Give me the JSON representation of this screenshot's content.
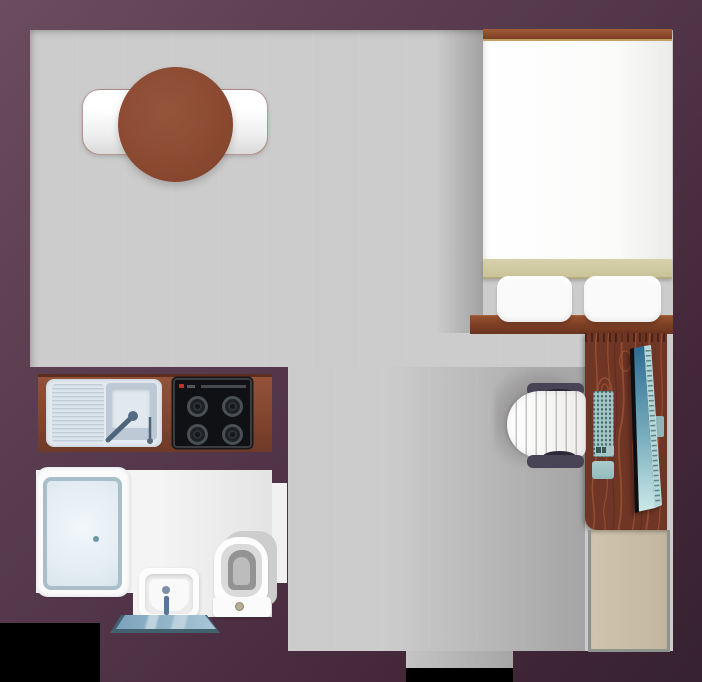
{
  "scene": {
    "title": "Studio apartment floor plan",
    "type": "floor-plan",
    "view": "top-down"
  },
  "palette": {
    "background": "#000000",
    "wall_light": "#6b4d5f",
    "wall_mid": "#53364a",
    "wall_dark": "#362230",
    "floor_gray": "#cccccc",
    "bath_floor": "#f4f4f4",
    "counter_wood": "#83462f",
    "desk_wood": "#6f3525",
    "desk_grain": "#9b5134",
    "table_wood": "#8b4a31",
    "bed_frame": "#7c3d24",
    "blanket_khaki": "#cac39a",
    "linen_white": "#fafafa",
    "stove_black": "#0f1114",
    "appliance_teal": "#a2c6c6",
    "screen_blue_top": "#2d6c93",
    "screen_blue_bottom": "#cdeaea",
    "mat_blue": "#7ba3bc",
    "plumbing_blue": "#57789c",
    "shower_tray": "#e3edf3",
    "wardrobe_beige": "#c2b69e",
    "chair_frame": "#494356"
  },
  "rooms": [
    {
      "id": "main-room",
      "label": "Main living / sleeping area"
    },
    {
      "id": "kitchen",
      "label": "Kitchenette"
    },
    {
      "id": "bathroom",
      "label": "Bathroom"
    }
  ],
  "furniture": [
    {
      "id": "dining-table",
      "label": "Round dining table with bench"
    },
    {
      "id": "bed",
      "label": "Double bed with two pillows and headboard"
    },
    {
      "id": "desk",
      "label": "Wooden desk with monitor, keyboard and mouse pad"
    },
    {
      "id": "office-chair",
      "label": "Office chair"
    },
    {
      "id": "wardrobe",
      "label": "Wardrobe"
    },
    {
      "id": "kitchen-counter",
      "label": "Counter with sink and 4-burner hob"
    },
    {
      "id": "shower",
      "label": "Shower enclosure with drain"
    },
    {
      "id": "bathroom-sink",
      "label": "Wash basin with faucet"
    },
    {
      "id": "toilet",
      "label": "Toilet with cistern and flush button"
    },
    {
      "id": "bath-mat",
      "label": "Bath mat"
    },
    {
      "id": "entry-door",
      "label": "Entry doorway (bottom center)"
    },
    {
      "id": "bathroom-door",
      "label": "Bathroom door opening (right side of bathroom)"
    }
  ]
}
